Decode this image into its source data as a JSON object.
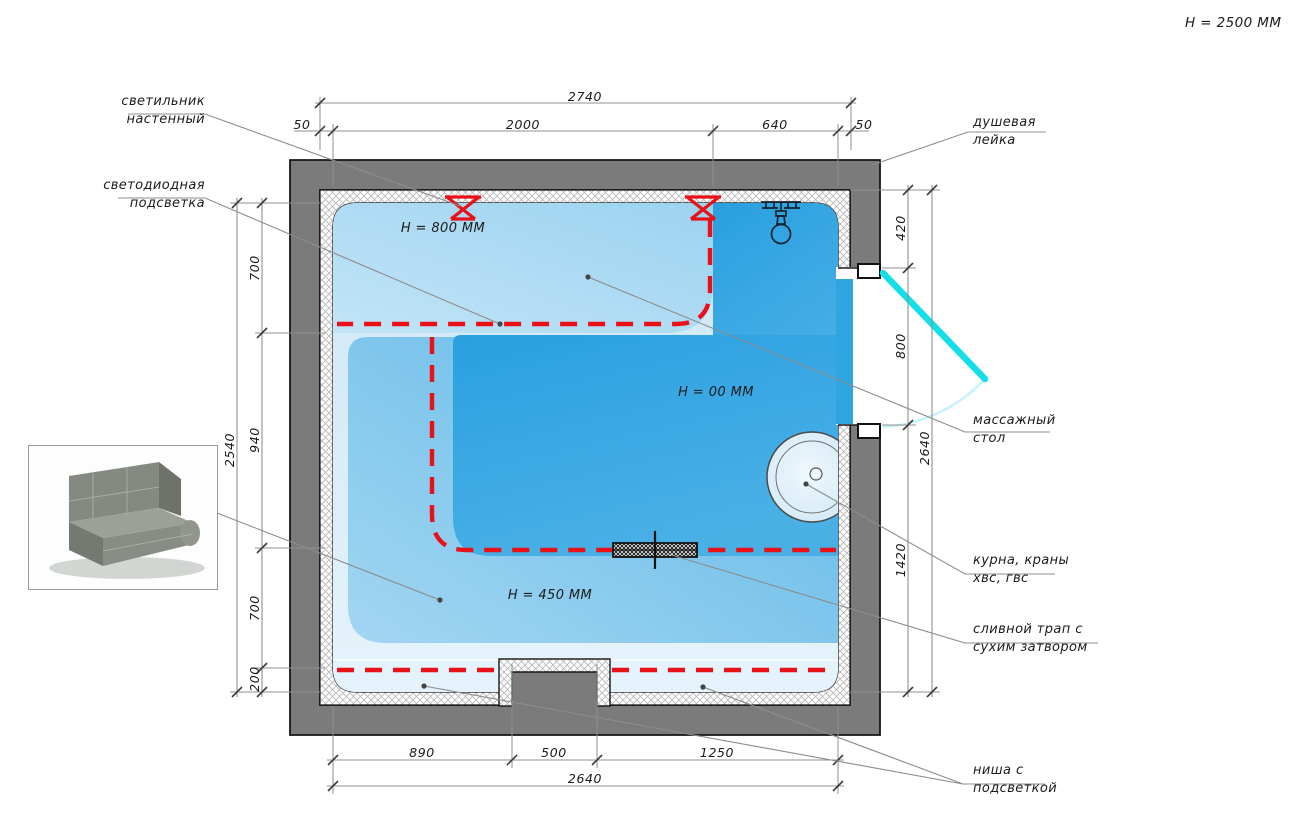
{
  "title": {
    "room_height_note": "Н = 2500 ММ"
  },
  "zone_labels": {
    "lounger_height": "Н = 800 ММ",
    "floor_height": "Н = 00 ММ",
    "bench_height": "Н = 450 ММ"
  },
  "callouts": {
    "wall_light": {
      "line1": "светильник",
      "line2": "настенный"
    },
    "led_strip": {
      "line1": "светодиодная",
      "line2": "подсветка"
    },
    "shower_head": {
      "line1": "душевая",
      "line2": "лейка"
    },
    "massage_table": {
      "line1": "массажный",
      "line2": "стол"
    },
    "kurna_taps": {
      "line1": "курна, краны",
      "line2": "хвс, гвс"
    },
    "drain_trap": {
      "line1": "сливной трап с",
      "line2": "сухим затвором"
    },
    "lit_niche": {
      "line1": "ниша с",
      "line2": "подсветкой"
    }
  },
  "dimensions": {
    "top": {
      "total": "2740",
      "segments": [
        "50",
        "2000",
        "640",
        "50"
      ]
    },
    "left": {
      "total": "2540",
      "segments": [
        "700",
        "940",
        "700",
        "200"
      ]
    },
    "right": {
      "total": "2640",
      "segments": [
        "420",
        "800",
        "1420"
      ]
    },
    "bottom": {
      "total": "2640",
      "segments": [
        "890",
        "500",
        "1250"
      ]
    }
  },
  "colors": {
    "wall_gray": "#7b7b7b",
    "zone_lounger": "#a6d8f2",
    "zone_floor": "#2fa5e2",
    "zone_bench": "#6fc0e9",
    "zone_pale": "#d8ecf9",
    "led_red": "#e91018",
    "door_cyan": "#14dfe9"
  }
}
